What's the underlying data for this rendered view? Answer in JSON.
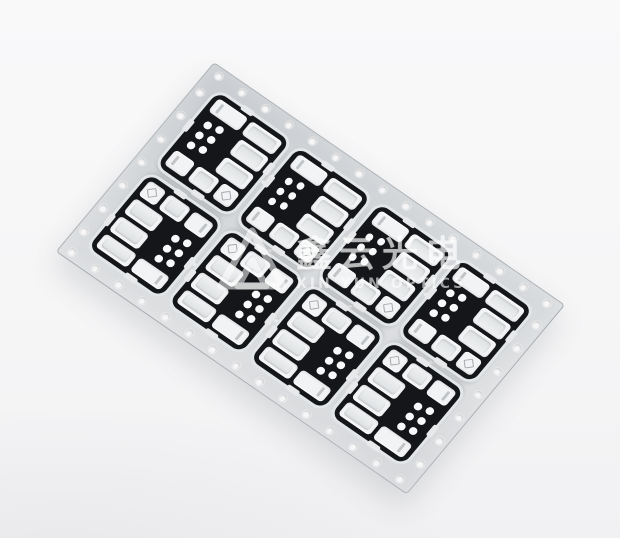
{
  "watermark": {
    "logo_icon": "triangle-prism-logo",
    "chinese": "鑫云光电",
    "english": "XIN YUN OPTICS",
    "color": "#ffffff",
    "opacity": 0.58
  },
  "panel": {
    "module_count": 8,
    "rows": 2,
    "cols": 4,
    "dots_per_module": 6,
    "holes": {
      "long_edge_count": 15,
      "short_edge_count": 7
    },
    "colors": {
      "background": "#f6f6f7",
      "carrier_gray": "#d5d8db",
      "module_black": "#141619",
      "module_white": "#f2f3f4",
      "pad_dot_white": "#f8f9fa"
    }
  }
}
